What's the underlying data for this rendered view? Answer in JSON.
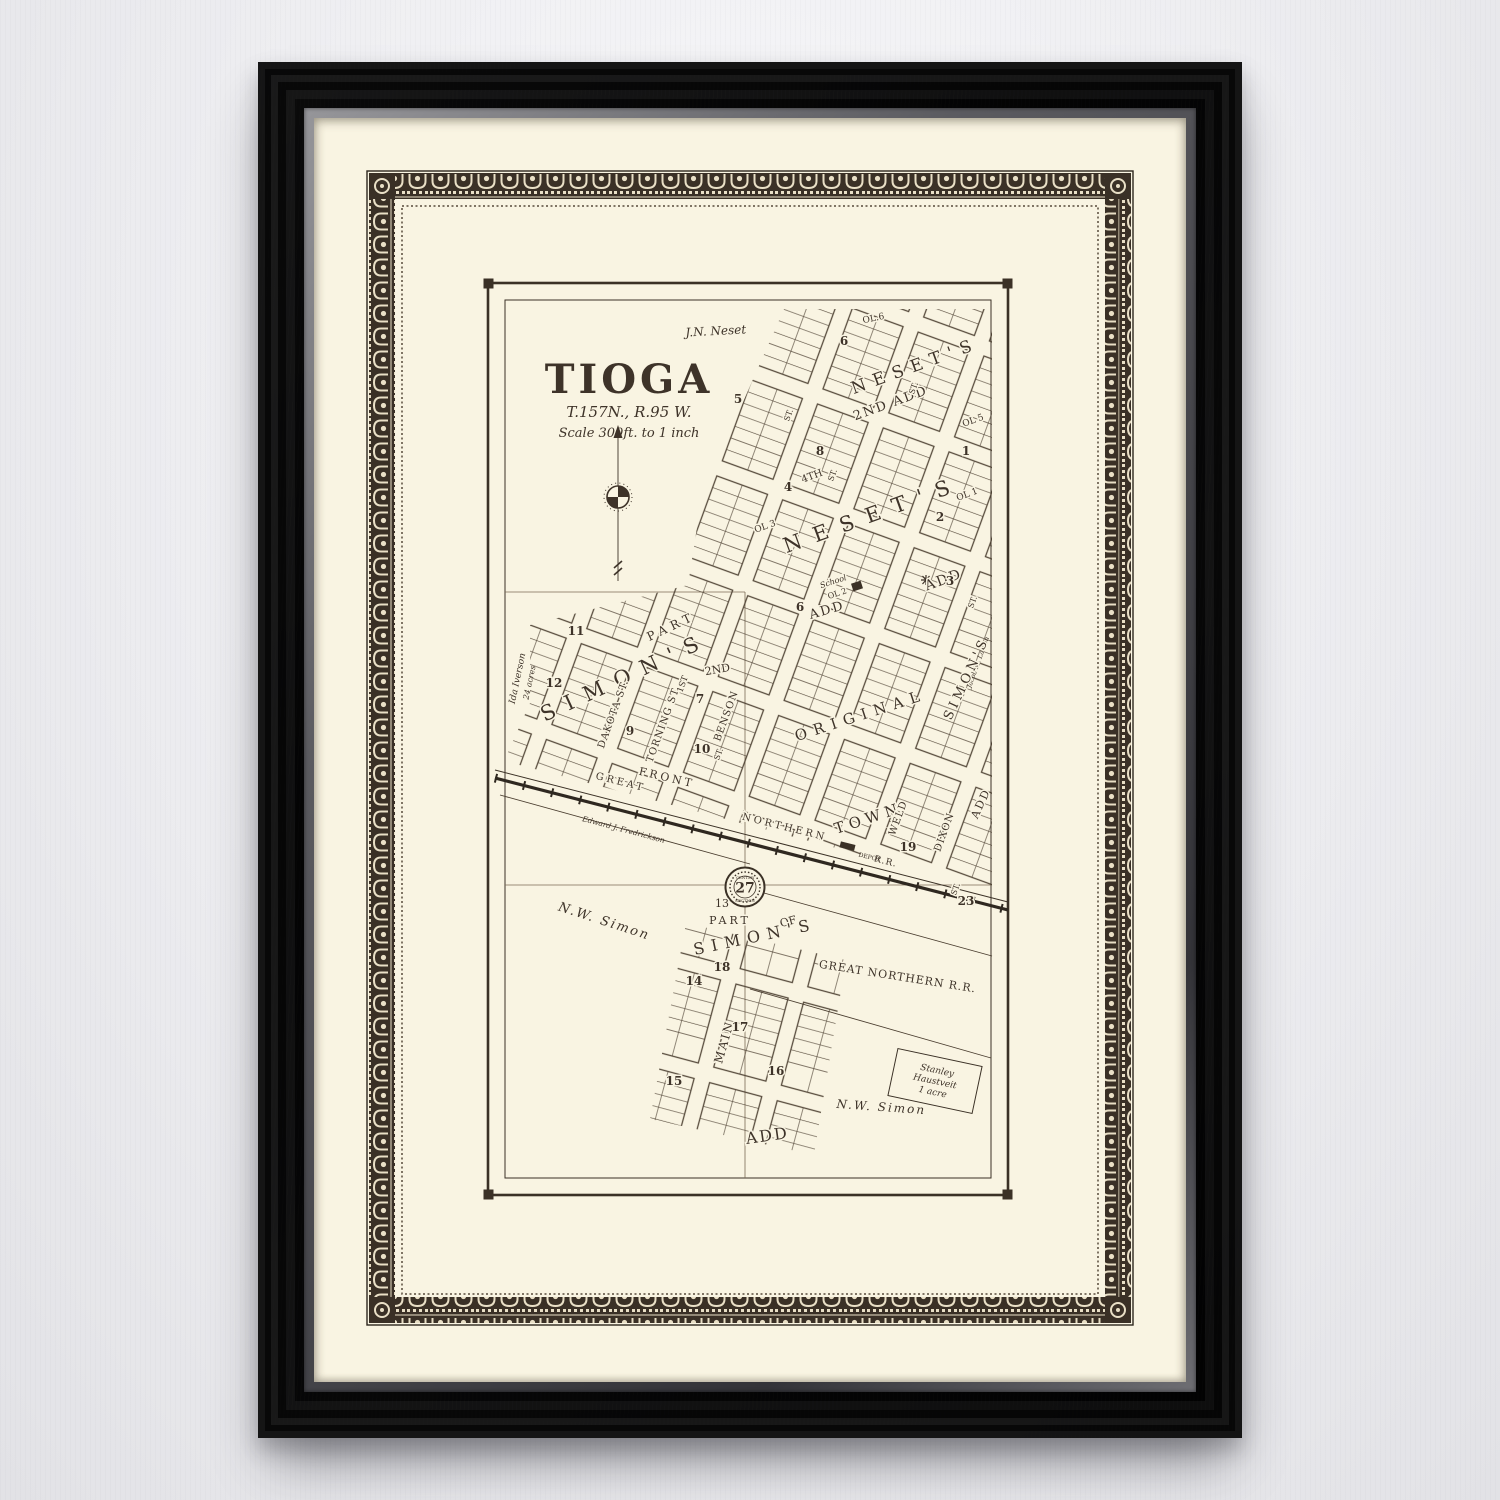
{
  "artwork": {
    "kind": "framed vintage plat map photo",
    "colors": {
      "wall": "#efeff2",
      "frame_wood": "#141416",
      "frame_lip": "#5b5b60",
      "mat_paper": "#f9f4e2",
      "ink": "#3e3329",
      "ornament_dark": "#3a3026",
      "ornament_light": "#e9dfc6"
    }
  },
  "map": {
    "title": "TIOGA",
    "township": "T.157N.,  R.95 W.",
    "scale": "Scale 300ft. to 1 inch",
    "owners": {
      "neset_top": "J.N. Neset",
      "ida1": "Ida Iverson",
      "ida2": "24 acres",
      "nw_simon_left": "N.W. Simon",
      "nw_simon_bottom": "N.W. Simon",
      "jacob": "Jacob M. Larson",
      "fredrickson": "Edward J. Fredrickson",
      "stanley1": "Stanley",
      "stanley2": "Haustveit",
      "stanley3": "1 acre"
    },
    "additions": {
      "neset2_name": "NESET'S",
      "neset2_sub": "2ND ADD",
      "neset_name": "NESET'S",
      "neset_add": "ADD",
      "neset3_add": "ADD",
      "original": "ORIGINAL",
      "town": "TOWN",
      "simon_name": "SIMON'S",
      "simon_part": "PART",
      "simon_right_name": "SIMON'S",
      "simon_right_add": "ADD",
      "part13_num": "13",
      "part13_word": "PART",
      "of_word": "OF",
      "simon_bottom_name": "SIMON'S",
      "add_bottom": "ADD"
    },
    "streets": {
      "dakota": "DAKOTA ST.",
      "torning": "TORNING ST.",
      "benson": "BENSON",
      "front": "FRONT",
      "weld": "WELD",
      "dixon": "DIXON",
      "main": "MAIN",
      "first": "1ST",
      "second": "2ND",
      "fourth": "4TH",
      "st": "ST."
    },
    "railroad": {
      "great": "GREAT",
      "northern": "NORTHERN",
      "rr": "R.R.",
      "full": "GREAT NORTHERN R.R.",
      "depot": "DEPOT"
    },
    "features": {
      "school": "School",
      "school_ol": "OL 2",
      "ol3": "OL 3",
      "ol1": "OL 1",
      "ol5": "OL 5",
      "ol6": "OL.6",
      "section_number": "27",
      "center_word": "CENTER",
      "section_word": "SECTION"
    },
    "blocks": [
      "5",
      "6",
      "8",
      "4",
      "2",
      "1",
      "11",
      "12",
      "9",
      "10",
      "7",
      "19",
      "23",
      "3",
      "14",
      "17",
      "15",
      "16",
      "18",
      "6"
    ]
  }
}
